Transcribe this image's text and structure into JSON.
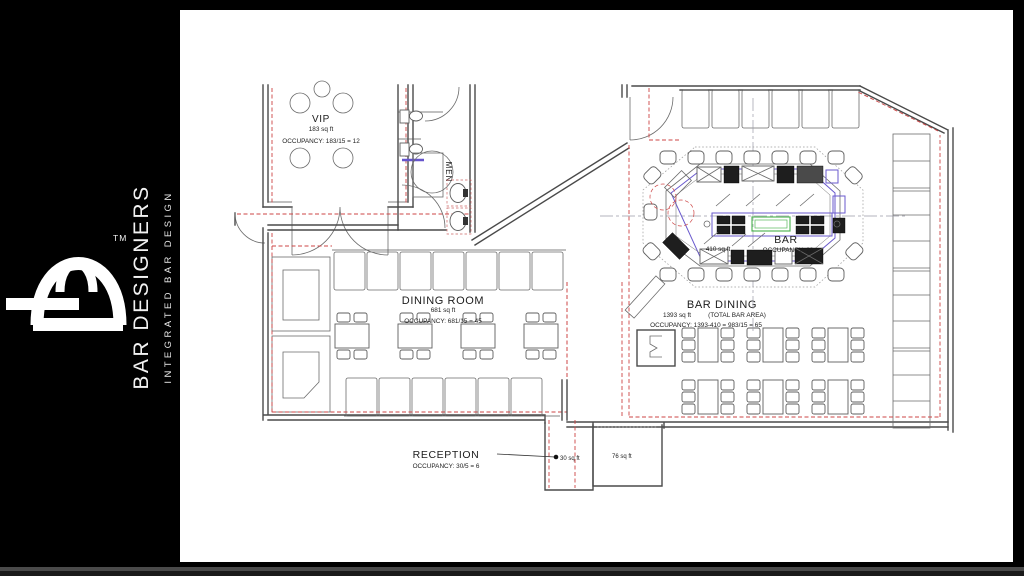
{
  "brand": {
    "trademark": "TM",
    "name": "BAR DESIGNERS",
    "tagline": "INTEGRATED BAR DESIGN"
  },
  "plan": {
    "vip": {
      "name": "VIP",
      "area": "183 sq ft",
      "occupancy": "OCCUPANCY: 183/15 = 12"
    },
    "mens_restroom": {
      "name": "MEN"
    },
    "dining_room": {
      "name": "DINING ROOM",
      "area": "681 sq ft",
      "occupancy": "OCCUPANCY: 681/15 = 45"
    },
    "bar": {
      "name": "BAR",
      "area": "410 sq ft",
      "occupancy": "OCCUPANCY: 29"
    },
    "bar_dining": {
      "name": "BAR DINING",
      "area": "1393 sq ft",
      "area_note": "(TOTAL BAR AREA)",
      "occupancy": "OCCUPANCY: 1393-410 = 983/15 = 65"
    },
    "reception": {
      "name": "RECEPTION",
      "occupancy": "OCCUPANCY: 30/5 = 6",
      "vestibule_area": "30 sq ft",
      "entry_area": "76 sq ft"
    }
  },
  "colors": {
    "background": "#000000",
    "paper": "#ffffff",
    "wall": "#4a4a4a",
    "egress_dashed": "#cc4444",
    "equipment": "#6a5acd",
    "highlight_green": "#56b85a"
  }
}
